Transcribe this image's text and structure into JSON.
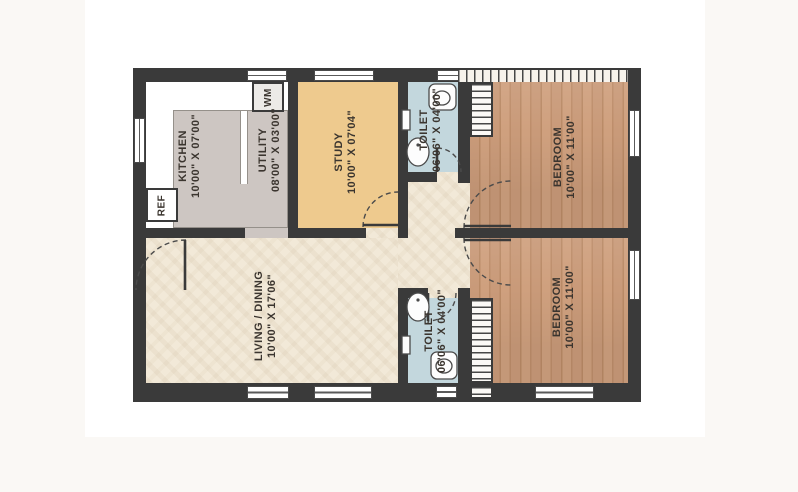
{
  "plan_title": "2 BHK floor plan",
  "rooms": {
    "kitchen": {
      "name": "KITCHEN",
      "dims": "10'00\" X 07'00\""
    },
    "utility": {
      "name": "UTILITY",
      "dims": "08'00\" X 03'00\""
    },
    "study": {
      "name": "STUDY",
      "dims": "10'00\" X 07'04\""
    },
    "toilet_top": {
      "name": "TOILET",
      "dims": "06'06\" X 04'00\""
    },
    "bedroom_top": {
      "name": "BEDROOM",
      "dims": "10'00\" X 11'00\""
    },
    "living_dining": {
      "name": "LIVING / DINING",
      "dims": "10'00\" X 17'06\""
    },
    "toilet_bottom": {
      "name": "TOILET",
      "dims": "06'06\" X 04'00\""
    },
    "bedroom_bottom": {
      "name": "BEDROOM",
      "dims": "10'00\" X 11'00\""
    }
  },
  "fixtures": {
    "refrigerator_label": "REF",
    "washing_machine_label": "WM"
  },
  "colors": {
    "wall": "#3a3a3a",
    "kitchen_utility_floor": "#cdc6c2",
    "study_floor": "#eeca8e",
    "toilet_floor": "#c3d7dd",
    "bedroom_wood_floor": "#c89877",
    "living_floor": "#f2e9d8",
    "sheet": "#ffffff",
    "page_background": "#faf8f5",
    "label_text": "#3b352f"
  }
}
